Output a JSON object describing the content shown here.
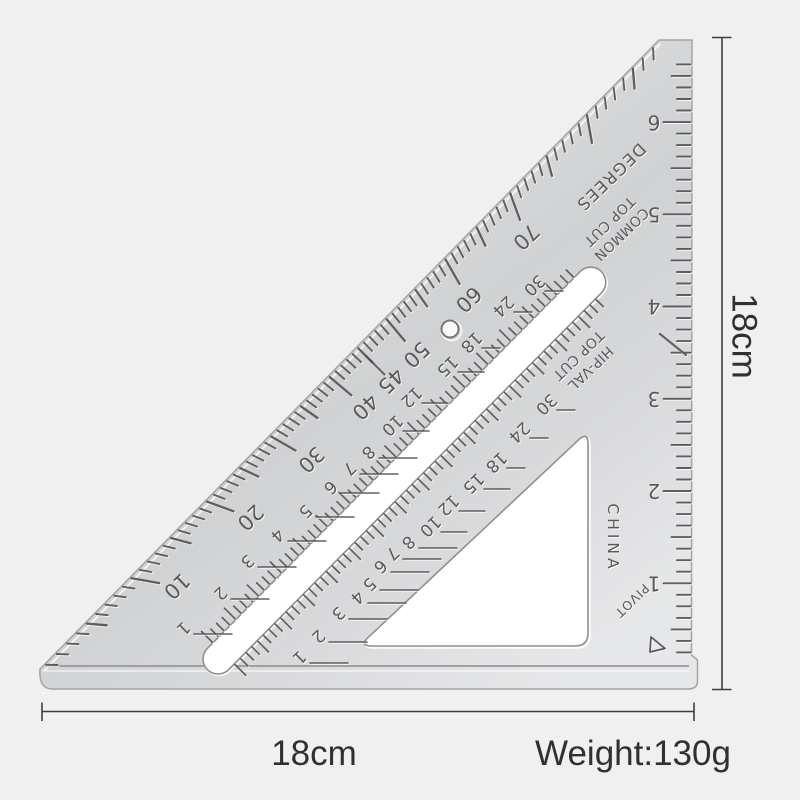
{
  "product": {
    "name": "aluminum triangle speed square ruler",
    "engravings": {
      "degrees_label": "DEGREES",
      "common_label_line1": "COMMON",
      "common_label_line2": "TOP CUT",
      "hipval_label_line1": "HIP-VAL",
      "hipval_label_line2": "TOP CUT",
      "origin_label": "CHINA",
      "pivot_label": "PIVOT"
    },
    "scales": {
      "degree_numbers": [
        10,
        20,
        30,
        40,
        45,
        50,
        60,
        70
      ],
      "common_top_cut_numbers": [
        1,
        2,
        3,
        4,
        5,
        6,
        7,
        8,
        10,
        12,
        15,
        18,
        24,
        30
      ],
      "hip_val_top_cut_numbers": [
        1,
        2,
        3,
        4,
        5,
        6,
        7,
        8,
        10,
        12,
        15,
        18,
        24,
        30
      ],
      "inch_numbers": [
        1,
        2,
        3,
        4,
        5,
        6
      ]
    }
  },
  "annotations": {
    "side_height": "18cm",
    "side_width": "18cm",
    "weight": "Weight:130g"
  },
  "colors": {
    "background": "#f0f0f1",
    "engraving": "#4a4b4d",
    "engraving_text": "#515254",
    "dimension_line": "#3d3d3f",
    "label_text": "#2f3033",
    "cutout": "#ffffff"
  }
}
